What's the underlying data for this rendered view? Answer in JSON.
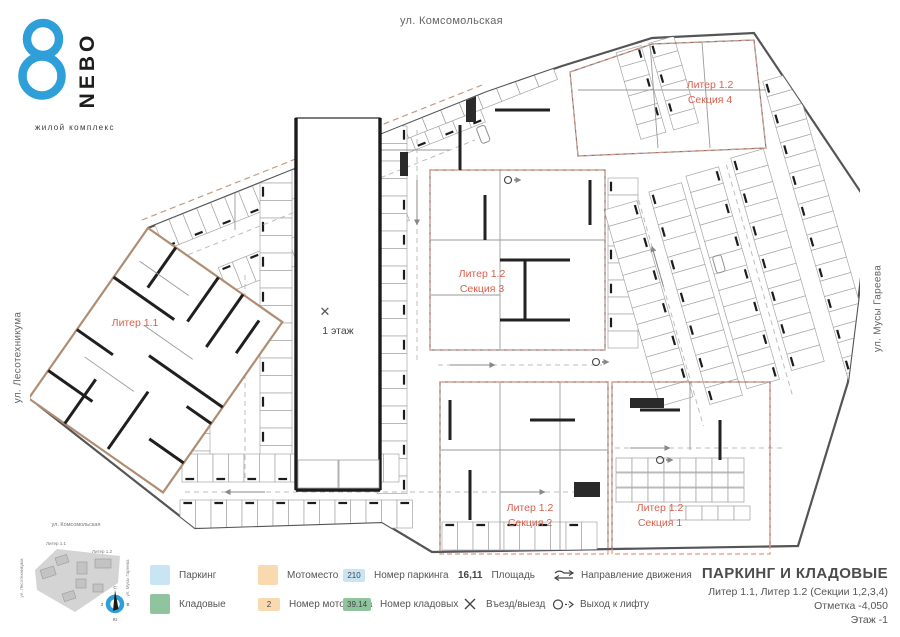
{
  "logo": {
    "brand": "NEBO",
    "tagline": "жилой комплекс",
    "accent_color": "#2e9fd8"
  },
  "streets": {
    "top": "ул. Комсомольская",
    "left": "ул. Лесотехникума",
    "right": "ул. Мусы Гареева"
  },
  "plan": {
    "liter11_label": "Литер 1.1",
    "floor1_label": "1 этаж",
    "entry_symbol": "✕",
    "sections": [
      {
        "label": "Литер 1.2",
        "sub": "Секция 4"
      },
      {
        "label": "Литер 1.2",
        "sub": "Секция 3"
      },
      {
        "label": "Литер 1.2",
        "sub": "Секция 2"
      },
      {
        "label": "Литер 1.2",
        "sub": "Секция 1"
      }
    ]
  },
  "minimap": {
    "street_top": "ул. Комсомольская",
    "street_left": "ул. Лесотехникума",
    "street_right": "ул. Мусы Гареева",
    "liter11": "Литер 1.1",
    "liter12": "Литер 1.2",
    "compass": {
      "n": "С",
      "e": "В",
      "s": "Ю",
      "w": "З"
    }
  },
  "legend": {
    "parking": {
      "label": "Паркинг"
    },
    "storage": {
      "label": "Кладовые"
    },
    "moto": {
      "label": "Мотоместо"
    },
    "moto_number": {
      "badge": "2",
      "label": "Номер мотоместа"
    },
    "parking_number": {
      "badge": "210",
      "label": "Номер паркинга"
    },
    "storage_number": {
      "badge": "39.14",
      "label": "Номер кладовых"
    },
    "area": {
      "value": "16,11",
      "label": "Площадь"
    },
    "entry": {
      "label": "Въезд/выезд"
    },
    "direction": {
      "label": "Направление движения"
    },
    "lift": {
      "label": "Выход к лифту"
    }
  },
  "title_block": {
    "title": "ПАРКИНГ И КЛАДОВЫЕ",
    "subtitle": "Литер 1.1, Литер 1.2 (Секции 1,2,3,4)",
    "mark": "Отметка  -4,050",
    "floor": "Этаж  -1"
  },
  "colors": {
    "parking": "#c9e5f4",
    "moto": "#f9d9b0",
    "storage": "#90c49e",
    "section_red": "#d95f4c",
    "section_dash": "#e09a86",
    "outline_tan": "#b08d72",
    "brand_blue": "#2e9fd8"
  }
}
